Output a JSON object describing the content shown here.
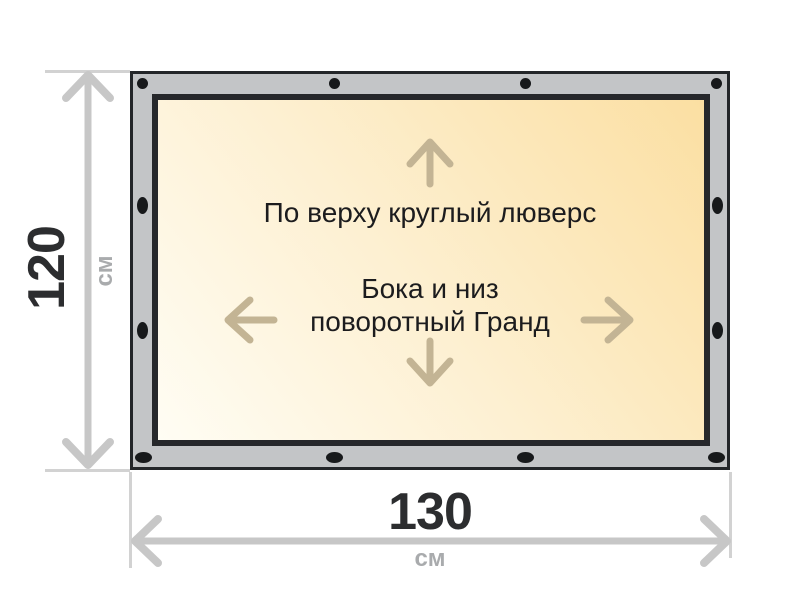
{
  "diagram": {
    "title_semantic": "banner-size-diagram",
    "panel_text": {
      "top_line": "По верху круглый люверс",
      "bottom_line1": "Бока и низ",
      "bottom_line2": "поворотный Гранд"
    },
    "height_dimension": {
      "value": "120",
      "unit": "см"
    },
    "width_dimension": {
      "value": "130",
      "unit": "см"
    },
    "eyelets": {
      "top_count": 4,
      "bottom_count": 4,
      "left_count": 2,
      "right_count": 2,
      "top_shape": "round",
      "side_and_bottom_shape": "oval-slot"
    },
    "icons": {
      "arrow_up": "↑",
      "arrow_down": "↓",
      "arrow_left": "←",
      "arrow_right": "→",
      "dimension_height": "↕",
      "dimension_width": "↔"
    },
    "colors": {
      "frame_gray": "#c3c5c7",
      "frame_border": "#232629",
      "panel_gradient_start": "#fffdf4",
      "panel_gradient_end": "#fbdfa2",
      "eyelet_black": "#17191b",
      "direction_arrow_tan": "#c3b494",
      "dimension_gray": "#c7c7c7",
      "dimension_value_color": "#2c2d2f",
      "unit_gray": "#a9abad",
      "panel_text_color": "#1c1c1e",
      "background": "#ffffff"
    }
  }
}
